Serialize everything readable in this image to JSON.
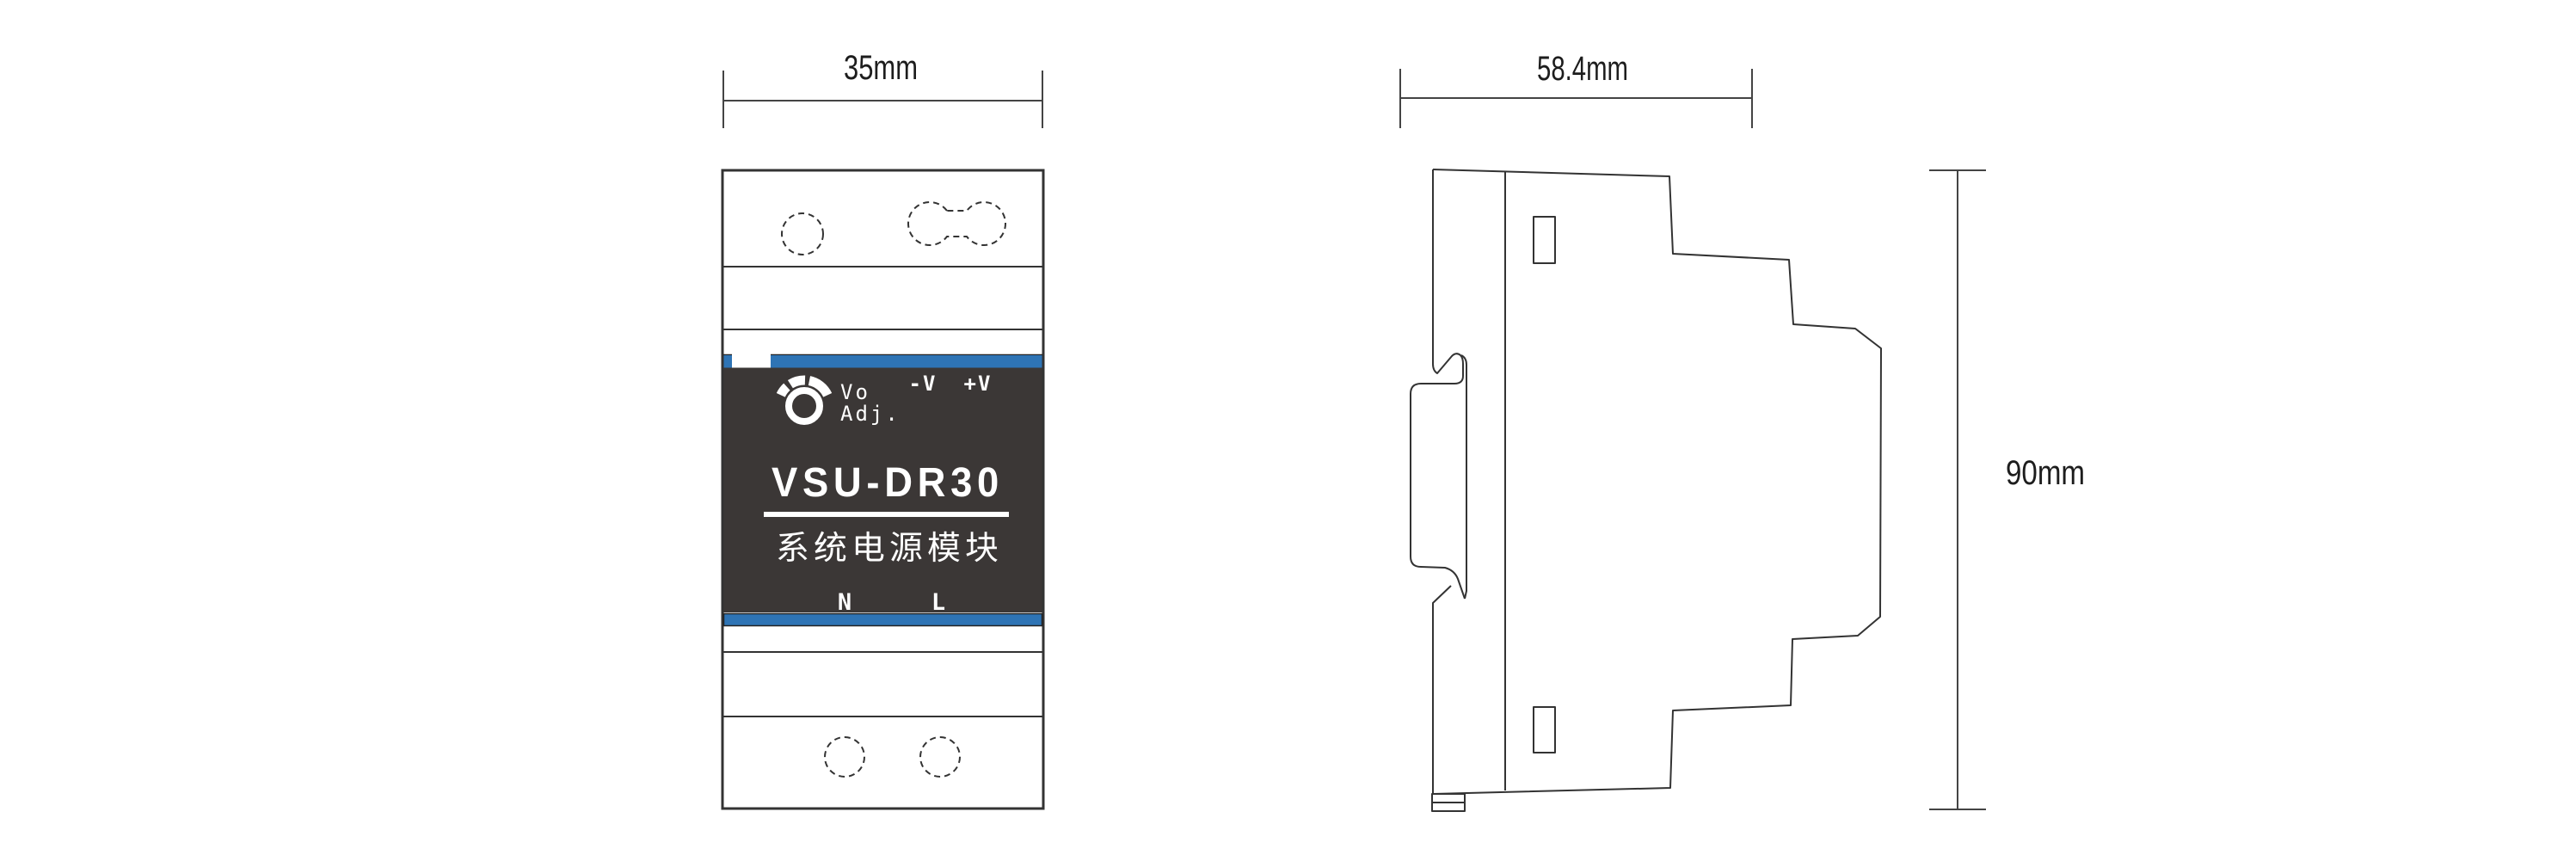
{
  "drawing": {
    "title_hint": "DIN-rail power module dimension drawing",
    "front_view": {
      "dimension_width": "35mm",
      "model_name": "VSU-DR30",
      "model_subtitle": "系统电源模块",
      "knob_label_line1": "Vo",
      "knob_label_line2": "Adj.",
      "output_negative": "-V",
      "output_positive": "+V",
      "terminal_neutral": "N",
      "terminal_line": "L"
    },
    "side_view": {
      "dimension_width": "58.4mm",
      "dimension_height": "90mm"
    },
    "colors": {
      "accent_blue": "#2E74B5",
      "label_background": "#3B3736",
      "line": "#333333",
      "label_text": "#ffffff"
    }
  }
}
